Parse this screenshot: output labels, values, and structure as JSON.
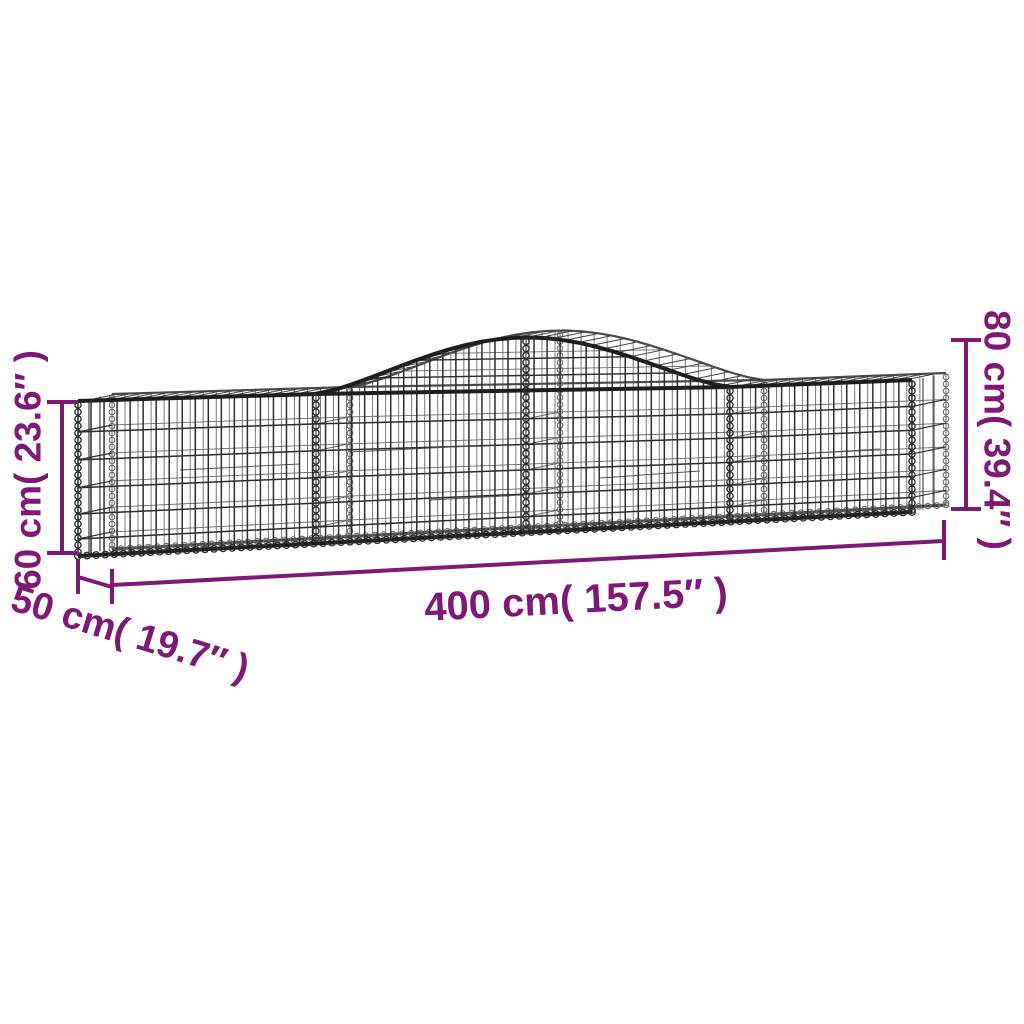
{
  "background_color": "#ffffff",
  "accent_color": "#801876",
  "wire_color": "#2d2d2d",
  "wire_back_color": "#6b6b6b",
  "wire_rail_color": "#1e1e1e",
  "figure": {
    "subject": "arched-gabion-basket-wireframe",
    "style": "product-dimension-diagram"
  },
  "dimensions": {
    "left_height": {
      "cm": 60,
      "inches": 23.6,
      "label": "60 cm( 23.6″ )"
    },
    "depth": {
      "cm": 50,
      "inches": 19.7,
      "label": "50 cm( 19.7″ )"
    },
    "length": {
      "cm": 400,
      "inches": 157.5,
      "label": "400 cm( 157.5″ )"
    },
    "right_height": {
      "cm": 80,
      "inches": 39.4,
      "label": "80 cm( 39.4″ )"
    }
  }
}
